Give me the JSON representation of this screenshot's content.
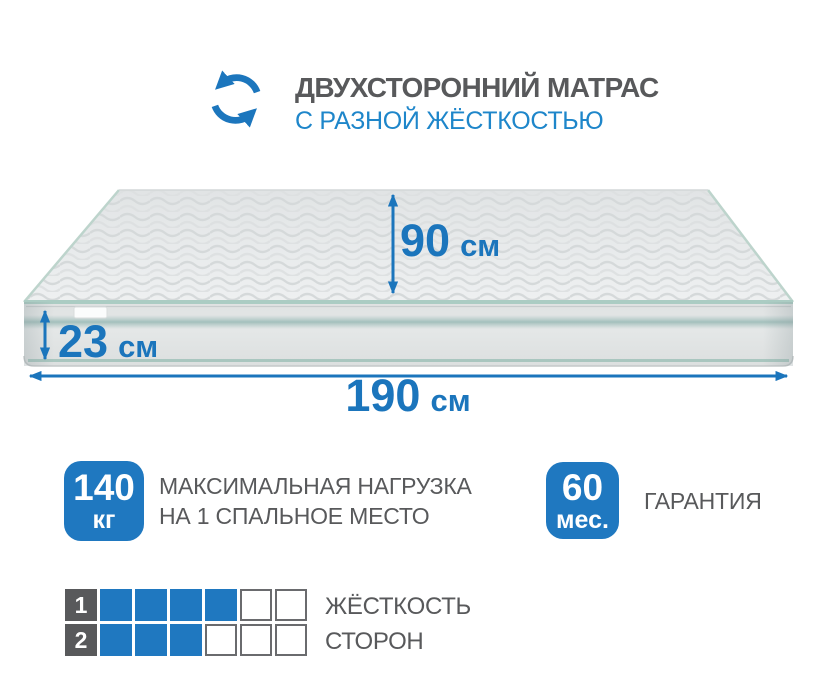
{
  "header": {
    "icon": "rotate-arrows-icon",
    "title": "ДВУХСТОРОННИЙ МАТРАС",
    "subtitle": "С РАЗНОЙ ЖЁСТКОСТЬЮ"
  },
  "mattress": {
    "width": {
      "value": "90",
      "unit": "см"
    },
    "height": {
      "value": "23",
      "unit": "см"
    },
    "length": {
      "value": "190",
      "unit": "см"
    }
  },
  "features": {
    "max_load": {
      "badge_value": "140",
      "badge_unit": "кг",
      "label_line1": "МАКСИМАЛЬНАЯ НАГРУЗКА",
      "label_line2": "НА 1 СПАЛЬНОЕ МЕСТО"
    },
    "warranty": {
      "badge_value": "60",
      "badge_unit": "мес.",
      "label": "ГАРАНТИЯ"
    }
  },
  "firmness": {
    "rows": [
      {
        "label": "1",
        "filled": 4,
        "total": 6
      },
      {
        "label": "2",
        "filled": 3,
        "total": 6
      }
    ],
    "caption_line1": "ЖЁСТКОСТЬ",
    "caption_line2": "СТОРОН"
  },
  "colors": {
    "accent_blue": "#1b75bc",
    "subtitle_blue": "#1e86ca",
    "badge_blue": "#1f78c0",
    "text_gray": "#58595b",
    "square_border_gray": "#6a6b6e",
    "piping_teal": "#abccc3"
  }
}
